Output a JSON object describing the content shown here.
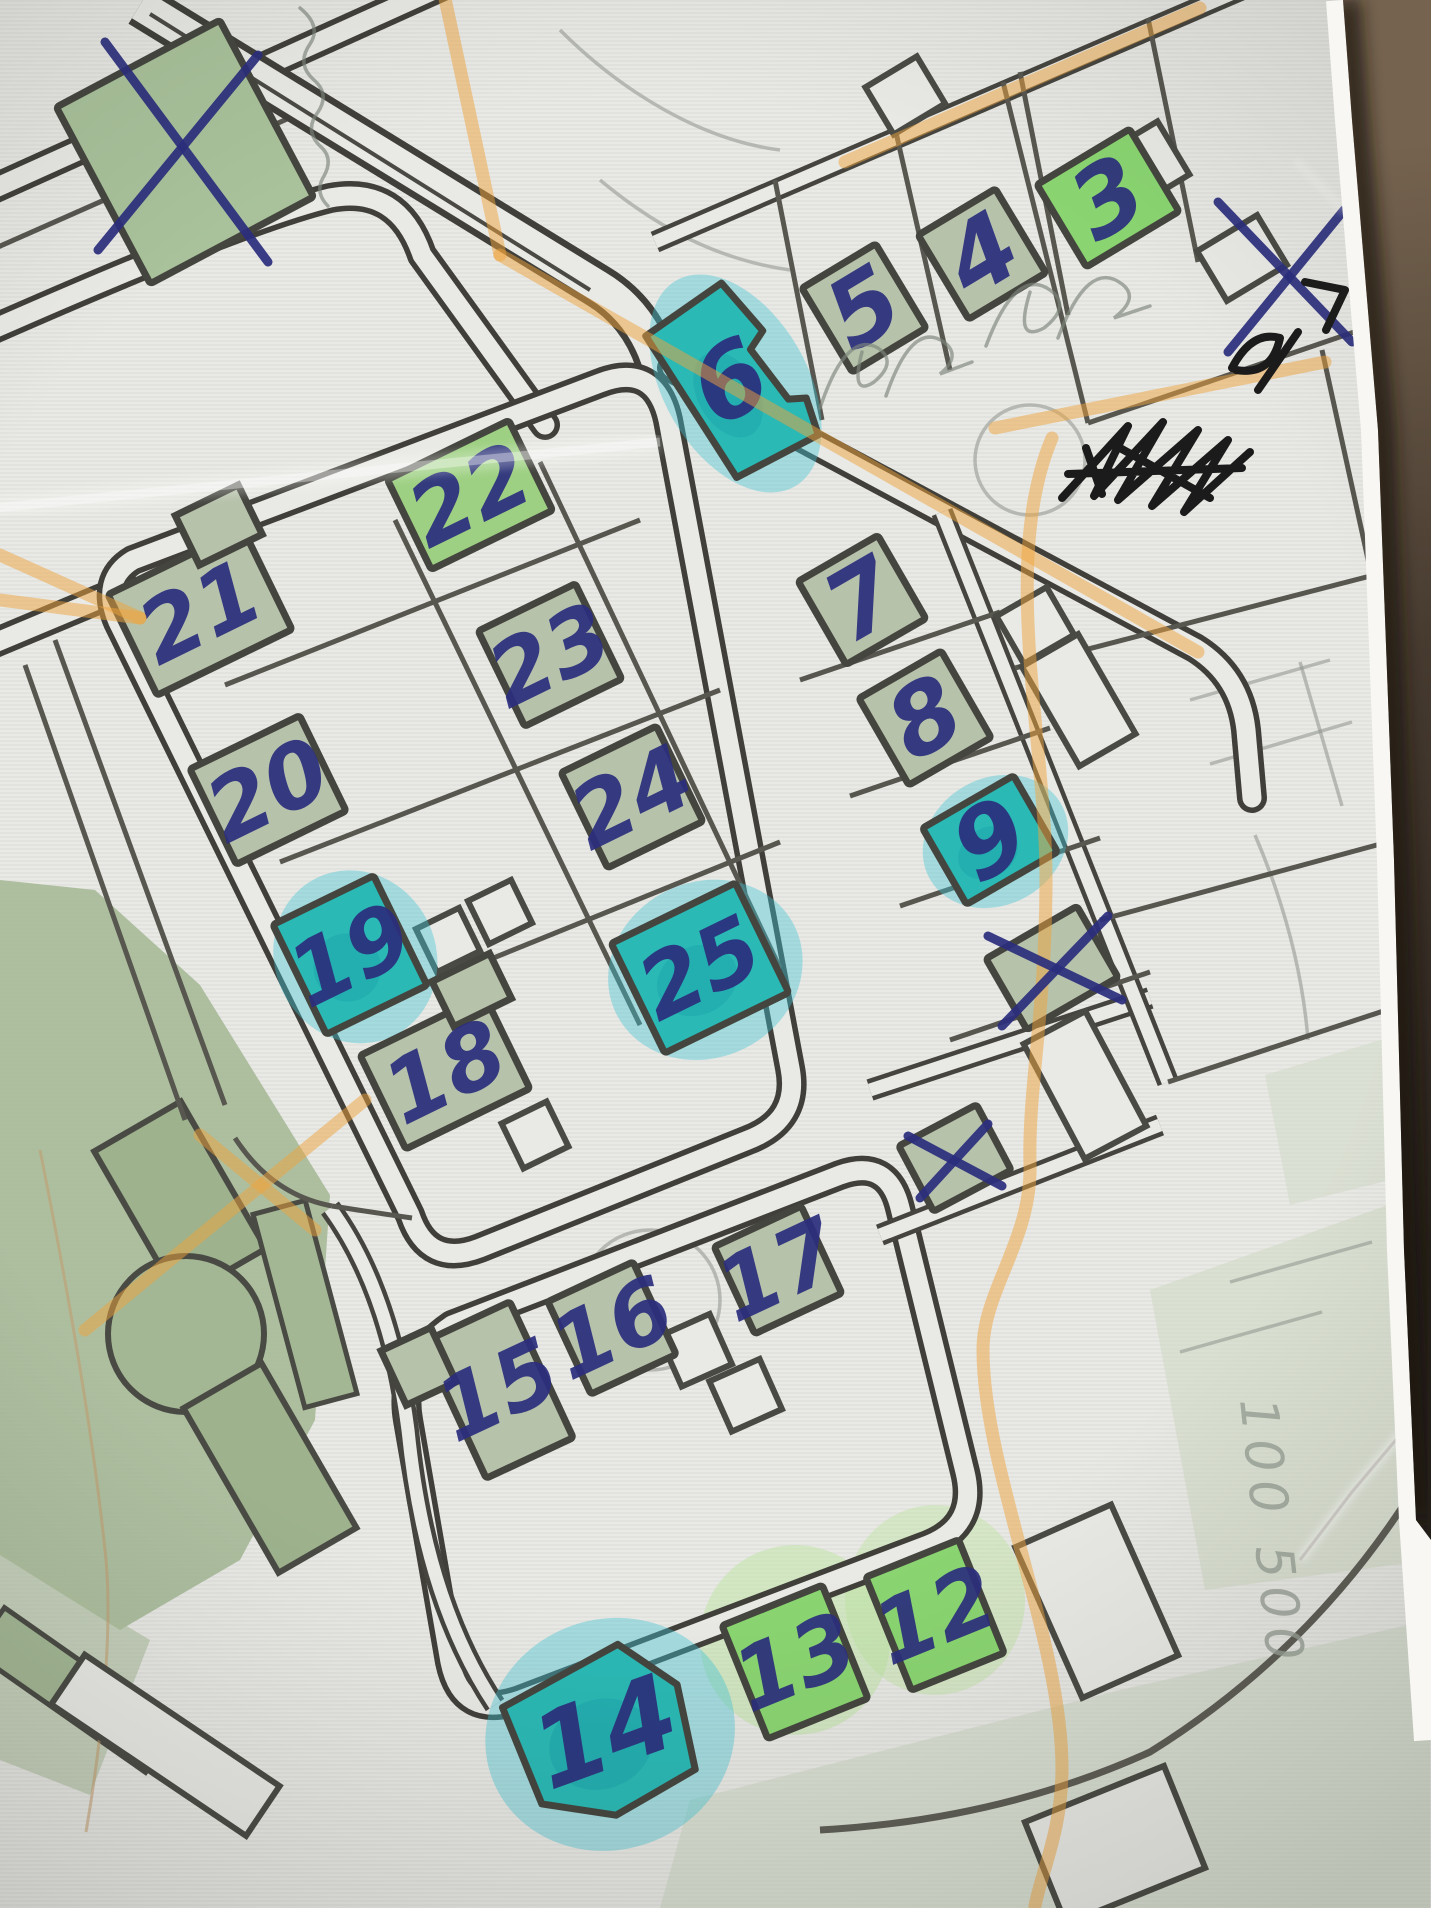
{
  "palette": {
    "paper": "#e9e9e5",
    "road": "#403f39",
    "pale": "#b7c2ab",
    "pale2": "#a9c29b",
    "bright": "#8ad571",
    "bright2": "#9ed083",
    "teal": "#2ab9b5",
    "teal_dark": "#189ba6",
    "teal_wash": "#3ec5d6",
    "green_wash": "#b9e49b",
    "park": "#a3b794",
    "park_dark": "#9db28d",
    "pen_blue": "#2b2e7d",
    "pen_black": "#1b1b1b",
    "pencil": "#7c857b",
    "highlighter": "#f0a43c",
    "leather_light": "#75634f",
    "leather_dark": "#241e19"
  },
  "map": {
    "buildings": [
      {
        "label": "",
        "x": 185,
        "y": 152,
        "w": 185,
        "h": 200,
        "rot": -28,
        "fill": "pale2"
      },
      {
        "label": "3",
        "x": 1108,
        "y": 198,
        "w": 108,
        "h": 96,
        "rot": -31,
        "fill": "bright"
      },
      {
        "label": "4",
        "x": 982,
        "y": 254,
        "w": 90,
        "h": 98,
        "rot": -31,
        "fill": "pale"
      },
      {
        "label": "5",
        "x": 864,
        "y": 308,
        "w": 86,
        "h": 98,
        "rot": -31,
        "fill": "pale"
      },
      {
        "label": "6",
        "x": 730,
        "y": 382,
        "w": 100,
        "h": 165,
        "rot": -30,
        "fill": "teal",
        "fs": 100,
        "shape": "M -50,-82 L 42,-90 L 54,-28 L 34,-18 L 42,44 L 58,52 L 50,90 L -42,86 Z"
      },
      {
        "label": "7",
        "x": 862,
        "y": 600,
        "w": 92,
        "h": 96,
        "rot": -30,
        "fill": "pale"
      },
      {
        "label": "8",
        "x": 925,
        "y": 718,
        "w": 95,
        "h": 100,
        "rot": -30,
        "fill": "pale"
      },
      {
        "label": "9",
        "x": 990,
        "y": 840,
        "w": 105,
        "h": 88,
        "rot": -30,
        "fill": "teal"
      },
      {
        "label": "",
        "x": 1052,
        "y": 968,
        "w": 105,
        "h": 82,
        "rot": -30,
        "fill": "pale"
      },
      {
        "label": "",
        "x": 955,
        "y": 1158,
        "w": 88,
        "h": 74,
        "rot": -28,
        "fill": "pale"
      },
      {
        "label": "22",
        "x": 470,
        "y": 495,
        "w": 135,
        "h": 100,
        "rot": -26,
        "fill": "bright2"
      },
      {
        "label": "21",
        "x": 200,
        "y": 612,
        "w": 150,
        "h": 112,
        "rot": -26,
        "fill": "pale",
        "notch": {
          "x": 55,
          "y": -70,
          "w": 70,
          "h": 55
        }
      },
      {
        "label": "23",
        "x": 550,
        "y": 655,
        "w": 108,
        "h": 106,
        "rot": -26,
        "fill": "pale"
      },
      {
        "label": "20",
        "x": 268,
        "y": 790,
        "w": 122,
        "h": 106,
        "rot": -26,
        "fill": "pale"
      },
      {
        "label": "24",
        "x": 632,
        "y": 797,
        "w": 106,
        "h": 106,
        "rot": -26,
        "fill": "pale"
      },
      {
        "label": "19",
        "x": 350,
        "y": 955,
        "w": 112,
        "h": 122,
        "rot": -26,
        "fill": "teal"
      },
      {
        "label": "25",
        "x": 700,
        "y": 968,
        "w": 138,
        "h": 122,
        "rot": -26,
        "fill": "teal"
      },
      {
        "label": "18",
        "x": 445,
        "y": 1072,
        "w": 138,
        "h": 104,
        "rot": -26,
        "fill": "pale",
        "notch": {
          "x": 60,
          "y": -62,
          "w": 64,
          "h": 50
        }
      },
      {
        "label": "17",
        "x": 778,
        "y": 1270,
        "w": 96,
        "h": 96,
        "rot": -25,
        "fill": "pale"
      },
      {
        "label": "16",
        "x": 612,
        "y": 1328,
        "w": 94,
        "h": 102,
        "rot": -25,
        "fill": "pale"
      },
      {
        "label": "15",
        "x": 498,
        "y": 1390,
        "w": 96,
        "h": 150,
        "rot": -25,
        "fill": "pale",
        "notch": {
          "x": -62,
          "y": -55,
          "w": 55,
          "h": 60
        }
      },
      {
        "label": "14",
        "x": 605,
        "y": 1732,
        "w": 175,
        "h": 160,
        "rot": -20,
        "fill": "teal",
        "fs": 104,
        "shape": "M -88,-58 L 42,-78 L 84,-20 L 72,66 L -18,82 L -84,46 Z"
      },
      {
        "label": "13",
        "x": 795,
        "y": 1662,
        "w": 108,
        "h": 122,
        "rot": -22,
        "fill": "bright"
      },
      {
        "label": "12",
        "x": 935,
        "y": 1615,
        "w": 100,
        "h": 122,
        "rot": -22,
        "fill": "bright"
      }
    ]
  },
  "annotations": {
    "x_marks": [
      {
        "name": "x-top-left-building",
        "lines": [
          [
            105,
            42,
            268,
            262
          ],
          [
            258,
            55,
            98,
            250
          ]
        ]
      },
      {
        "name": "x-paper-edge",
        "lines": [
          [
            1218,
            202,
            1352,
            342
          ],
          [
            1344,
            210,
            1228,
            352
          ]
        ]
      },
      {
        "name": "x-right-middle-building",
        "lines": [
          [
            988,
            936,
            1122,
            1000
          ],
          [
            1108,
            916,
            1002,
            1026
          ]
        ]
      },
      {
        "name": "x-small-building",
        "lines": [
          [
            908,
            1136,
            1002,
            1186
          ],
          [
            988,
            1124,
            920,
            1198
          ]
        ]
      }
    ],
    "black_scribbles": [
      "M 1062,498 L 1128,426 L 1094,496 L 1163,422 L 1118,500 L 1198,430 L 1152,506 L 1228,440 L 1184,512 L 1250,452 M 1068,474 L 1242,468 M 1086,448 L 1102,494 M 1120,448 L 1210,498",
      "M 1232,368 Q 1252,330 1280,338 Q 1272,376 1236,370 M 1258,390 L 1298,332 M 1305,282 L 1345,290 L 1326,330"
    ],
    "pencil_scribbles": [
      "M 820,408 Q 846,330 878,348 Q 898,362 874,382 Q 850,398 862,352 M 886,396 Q 912,320 944,342 Q 962,356 940,374 L 972,362",
      "M 986,346 Q 1016,266 1050,290 Q 1072,306 1044,328 Q 1014,344 1030,292 M 1058,338 Q 1088,258 1122,284 Q 1140,298 1114,318 L 1150,306",
      "M 300,8 Q 322,26 310,44 Q 296,64 314,80 Q 330,94 318,112 Q 304,130 320,146 Q 334,158 324,176 Q 314,192 328,206"
    ],
    "pencil_note": {
      "text": "100 500",
      "transform": "translate(1240,1400) rotate(84)"
    },
    "highlighter": {
      "paths": [
        "M 444,-6 L 500,255",
        "M 500,255 L 1198,652",
        "M 845,162 L 1200,8",
        "M 995,428 L 1325,362",
        "M 1052,438 C 1000,560 1046,740 1046,878 C 1046,1010 1028,1090 1030,1164 C 1032,1240 983,1290 983,1350 C 983,1470 1062,1640 1062,1768 C 1062,1830 1042,1870 1035,1906",
        "M 365,1100 L 85,1330",
        "M 200,1135 L 315,1230",
        "M 0,555 L 140,618",
        "M 0,600 L 140,618"
      ]
    }
  }
}
